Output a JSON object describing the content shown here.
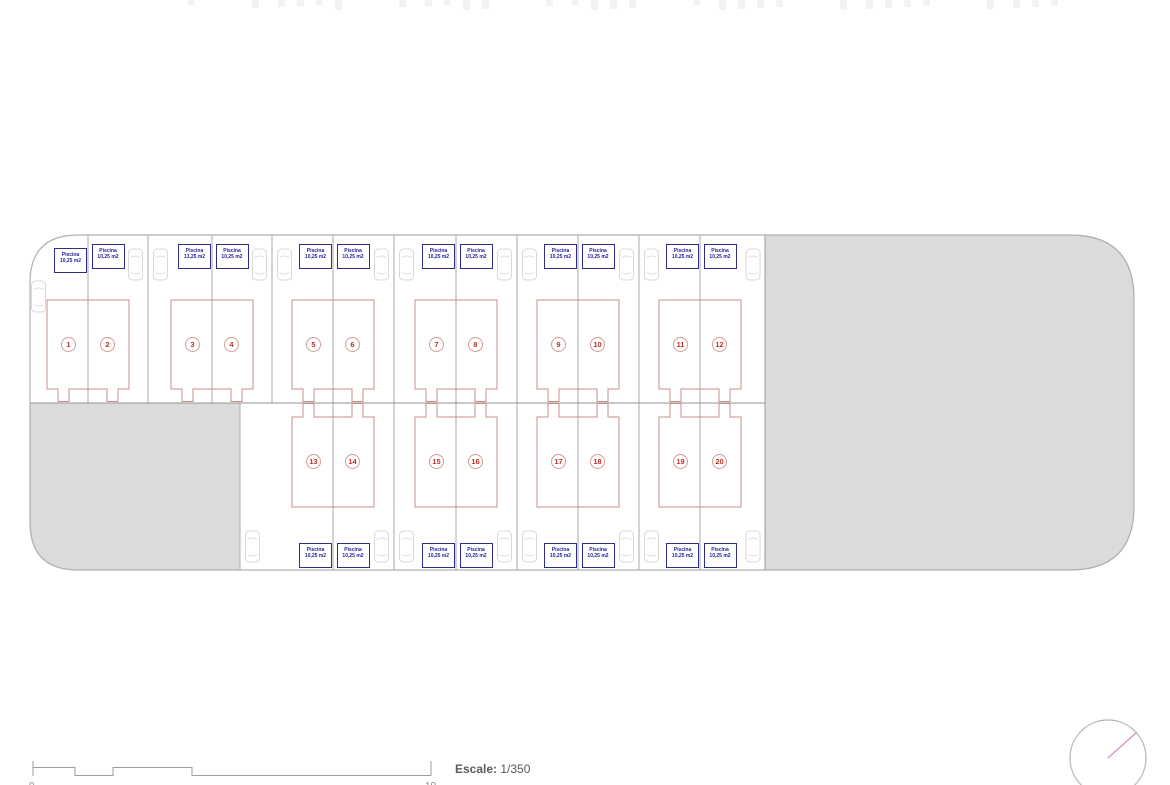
{
  "plan": {
    "pool_label_note": "each unit has a pool label box",
    "units": [
      {
        "number": "1",
        "pool_label": "Piscina",
        "pool_area": "10,25 m2"
      },
      {
        "number": "2",
        "pool_label": "Piscina",
        "pool_area": "10,25 m2"
      },
      {
        "number": "3",
        "pool_label": "Piscina",
        "pool_area": "13,25 m2"
      },
      {
        "number": "4",
        "pool_label": "Piscina",
        "pool_area": "10,25 m2"
      },
      {
        "number": "5",
        "pool_label": "Piscina",
        "pool_area": "10,25 m2"
      },
      {
        "number": "6",
        "pool_label": "Piscina",
        "pool_area": "10,25 m2"
      },
      {
        "number": "7",
        "pool_label": "Piscina",
        "pool_area": "10,25 m2"
      },
      {
        "number": "8",
        "pool_label": "Piscina",
        "pool_area": "10,25 m2"
      },
      {
        "number": "9",
        "pool_label": "Piscina",
        "pool_area": "10,25 m2"
      },
      {
        "number": "10",
        "pool_label": "Piscina",
        "pool_area": "10,25 m2"
      },
      {
        "number": "11",
        "pool_label": "Piscina",
        "pool_area": "10,25 m2"
      },
      {
        "number": "12",
        "pool_label": "Piscina",
        "pool_area": "10,25 m2"
      },
      {
        "number": "13",
        "pool_label": "Piscina",
        "pool_area": "10,25 m2"
      },
      {
        "number": "14",
        "pool_label": "Piscina",
        "pool_area": "10,25 m2"
      },
      {
        "number": "15",
        "pool_label": "Piscina",
        "pool_area": "10,25 m2"
      },
      {
        "number": "16",
        "pool_label": "Piscina",
        "pool_area": "10,25 m2"
      },
      {
        "number": "17",
        "pool_label": "Piscina",
        "pool_area": "10,25 m2"
      },
      {
        "number": "18",
        "pool_label": "Piscina",
        "pool_area": "10,25 m2"
      },
      {
        "number": "19",
        "pool_label": "Piscina",
        "pool_area": "10,25 m2"
      },
      {
        "number": "20",
        "pool_label": "Piscina",
        "pool_area": "10,25 m2"
      }
    ]
  },
  "scale": {
    "label": "Escale:",
    "value": "1/350",
    "left_tick_label": "0",
    "right_tick_label": "10"
  },
  "icons": {
    "compass": "north-arrow-compass"
  },
  "colors": {
    "gray_fill": "#dbdbdb",
    "boundary_line": "#b0b0b0",
    "divider_line": "#939393",
    "plot_outline_red": "#c98f84",
    "unit_number_red": "#bb2f28",
    "pool_box_blue": "#2d2d8f",
    "compass_needle_pink": "#cf9fcc",
    "scale_text_gray": "#5a5a5a"
  }
}
